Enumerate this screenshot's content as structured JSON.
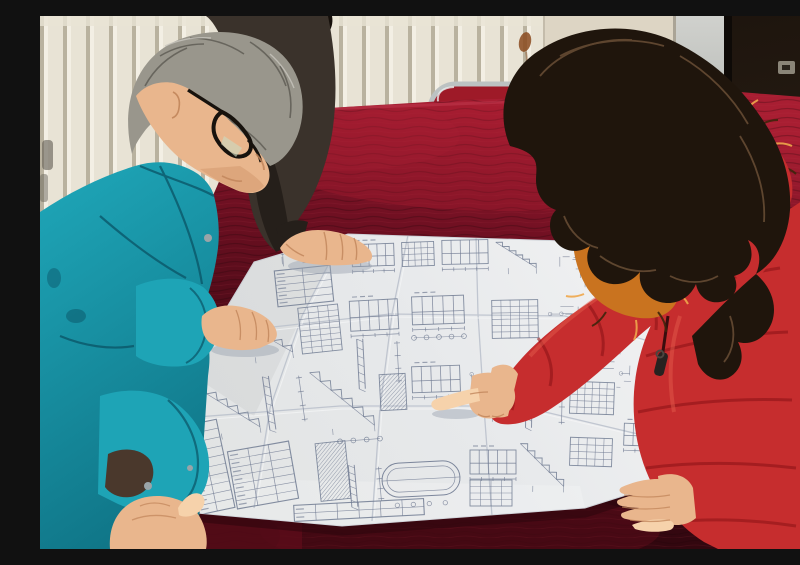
{
  "meta": {
    "title": "Two workers reviewing a construction blueprint on a velvet-covered table"
  },
  "scene": {
    "description": "A gray-haired man in a teal work jacket and glasses, a partially visible colleague in a dark jacket, and a woman in a red down coat with a fur-trimmed hood lean over a large folded construction blueprint spread on a dark red velvet table; the woman points at a detail on the drawing.",
    "people": [
      {
        "id": "man-teal-jacket",
        "label": "gray-haired man wearing glasses and a teal work jacket, leaning over the plan with both hands on it"
      },
      {
        "id": "person-dark-jacket",
        "label": "colleague in a dark jacket, mostly hidden, resting one hand on the top edge of the plan"
      },
      {
        "id": "woman-red-coat",
        "label": "woman in a red quilted down coat with orange fur hood trim, pointing at the blueprint with her index finger"
      }
    ],
    "objects": [
      {
        "id": "blueprint",
        "label": "large folded white construction drawing sheet with stair details, elevations, tables and section details"
      },
      {
        "id": "velvet-table",
        "label": "table covered with dark red velvet cloth"
      },
      {
        "id": "banquet-chair",
        "label": "chrome-framed chair with red upholstered back behind the table"
      },
      {
        "id": "radiator-wall",
        "label": "cream wall with vertical radiator fins"
      },
      {
        "id": "dark-door",
        "label": "dark brown door panel with small metal latch"
      }
    ]
  },
  "palette": {
    "wallCream": "#e8e3d5",
    "finShadow": "#b9b29f",
    "finLight": "#f3efe4",
    "wallBeige": "#ddd5c4",
    "lightPanel": "#d0d1cd",
    "panelDark": "#9fa4a1",
    "frameDark": "#0e0a07",
    "darkWall": "#1e150e",
    "darkWall2": "#342718",
    "rust": "#8a4a1e",
    "chrome": "#bcc2c2",
    "chairRed": "#9e1a28",
    "velvetTop": "#a81e32",
    "velvetMid": "#701022",
    "velvetDark": "#470a16",
    "velvetDeep": "#2c060d",
    "paper": "#e7e9eb",
    "paperShade": "#ccd1da",
    "ink": "#707b92",
    "crease": "#bcc2cd",
    "white": "#f6f7f8",
    "teal": "#1ea4b6",
    "tealDark": "#0d6d7f",
    "tealDeep": "#0a5365",
    "skin": "#e9b68d",
    "skinHi": "#f6d2ab",
    "skinSh": "#c1855a",
    "hairGray": "#99968c",
    "hairGrayD": "#5c5a52",
    "glassesC": "#17120d",
    "darkJk": "#3a322b",
    "darkJkSh": "#251f1a",
    "blackHair": "#150f0a",
    "wHair": "#1f150c",
    "wHairHi": "#6e5238",
    "redC": "#c62d2e",
    "redDk": "#8f1417",
    "redDeep": "#6d0e10",
    "redHi": "#e15a49",
    "furC": "#c9731f",
    "furHi": "#f0a84c",
    "furDk": "#3f250c",
    "zipperC": "#262220",
    "shadowInk": "#9aa2b0"
  },
  "blueprint": {
    "clusters": [
      {
        "t": "scatter",
        "x": 238,
        "y": 234,
        "w": 58,
        "h": 14,
        "n": 6,
        "rot": -4
      },
      {
        "t": "table",
        "x": 236,
        "y": 252,
        "w": 56,
        "h": 36,
        "rows": 5,
        "cols": 2,
        "rot": -6
      },
      {
        "t": "elev",
        "x": 312,
        "y": 228,
        "w": 42,
        "h": 22,
        "rot": -2
      },
      {
        "t": "grid",
        "x": 362,
        "y": 226,
        "w": 32,
        "h": 24,
        "rows": 4,
        "cols": 5,
        "rot": -2
      },
      {
        "t": "elev",
        "x": 402,
        "y": 224,
        "w": 46,
        "h": 24,
        "rot": -1
      },
      {
        "t": "stairs",
        "x": 456,
        "y": 226,
        "w": 40,
        "h": 26,
        "rot": -1
      },
      {
        "t": "scatter",
        "x": 504,
        "y": 232,
        "w": 44,
        "h": 26,
        "n": 9,
        "rot": 0
      },
      {
        "t": "stairs",
        "x": 196,
        "y": 298,
        "w": 54,
        "h": 42,
        "rot": -8
      },
      {
        "t": "grid",
        "x": 260,
        "y": 290,
        "w": 40,
        "h": 46,
        "rows": 8,
        "cols": 4,
        "rot": -6
      },
      {
        "t": "elev",
        "x": 310,
        "y": 284,
        "w": 48,
        "h": 30,
        "rot": -3
      },
      {
        "t": "section",
        "x": 318,
        "y": 322,
        "w": 40,
        "h": 50,
        "rot": -3
      },
      {
        "t": "elev",
        "x": 372,
        "y": 280,
        "w": 52,
        "h": 28,
        "rot": -2
      },
      {
        "t": "circles",
        "x": 374,
        "y": 316,
        "w": 50,
        "h": 10,
        "k": 5,
        "rot": -2
      },
      {
        "t": "grid",
        "x": 452,
        "y": 284,
        "w": 46,
        "h": 38,
        "rows": 6,
        "cols": 5,
        "rot": -1
      },
      {
        "t": "scatter",
        "x": 506,
        "y": 288,
        "w": 40,
        "h": 42,
        "n": 12,
        "rot": 0
      },
      {
        "t": "scatter",
        "x": 556,
        "y": 318,
        "w": 44,
        "h": 56,
        "n": 10,
        "rot": 2
      },
      {
        "t": "stairs",
        "x": 160,
        "y": 366,
        "w": 56,
        "h": 50,
        "rot": -10
      },
      {
        "t": "section",
        "x": 226,
        "y": 358,
        "w": 36,
        "h": 54,
        "rot": -8
      },
      {
        "t": "stairs",
        "x": 272,
        "y": 354,
        "w": 60,
        "h": 58,
        "rot": -5
      },
      {
        "t": "hatch",
        "x": 340,
        "y": 358,
        "w": 26,
        "h": 36,
        "rot": -3
      },
      {
        "t": "elev",
        "x": 372,
        "y": 350,
        "w": 48,
        "h": 26,
        "rot": -2
      },
      {
        "t": "scatter",
        "x": 430,
        "y": 358,
        "w": 48,
        "h": 50,
        "n": 13,
        "rot": 0
      },
      {
        "t": "section",
        "x": 486,
        "y": 354,
        "w": 36,
        "h": 58,
        "rot": 1
      },
      {
        "t": "grid",
        "x": 530,
        "y": 366,
        "w": 44,
        "h": 32,
        "rows": 5,
        "cols": 6,
        "rot": 2
      },
      {
        "t": "table",
        "x": 150,
        "y": 406,
        "w": 36,
        "h": 90,
        "rows": 10,
        "cols": 2,
        "rot": -12
      },
      {
        "t": "table",
        "x": 192,
        "y": 430,
        "w": 62,
        "h": 58,
        "rows": 7,
        "cols": 3,
        "rot": -10
      },
      {
        "t": "hatch",
        "x": 278,
        "y": 426,
        "w": 30,
        "h": 58,
        "rot": -6
      },
      {
        "t": "section",
        "x": 310,
        "y": 448,
        "w": 30,
        "h": 42,
        "rot": -5
      },
      {
        "t": "stadium",
        "x": 342,
        "y": 446,
        "w": 78,
        "h": 34,
        "rot": -3
      },
      {
        "t": "table",
        "x": 254,
        "y": 486,
        "w": 130,
        "h": 16,
        "rows": 2,
        "cols": 6,
        "rot": -3
      },
      {
        "t": "elev",
        "x": 430,
        "y": 434,
        "w": 46,
        "h": 24,
        "rot": 0
      },
      {
        "t": "grid",
        "x": 430,
        "y": 464,
        "w": 42,
        "h": 26,
        "rows": 4,
        "cols": 4,
        "rot": 0
      },
      {
        "t": "stairs",
        "x": 480,
        "y": 428,
        "w": 44,
        "h": 42,
        "rot": 1
      },
      {
        "t": "grid",
        "x": 530,
        "y": 422,
        "w": 42,
        "h": 28,
        "rows": 4,
        "cols": 5,
        "rot": 2
      },
      {
        "t": "elev",
        "x": 584,
        "y": 408,
        "w": 46,
        "h": 22,
        "rot": 2
      },
      {
        "t": "circles",
        "x": 300,
        "y": 420,
        "w": 40,
        "h": 8,
        "k": 4,
        "rot": -4
      }
    ]
  }
}
